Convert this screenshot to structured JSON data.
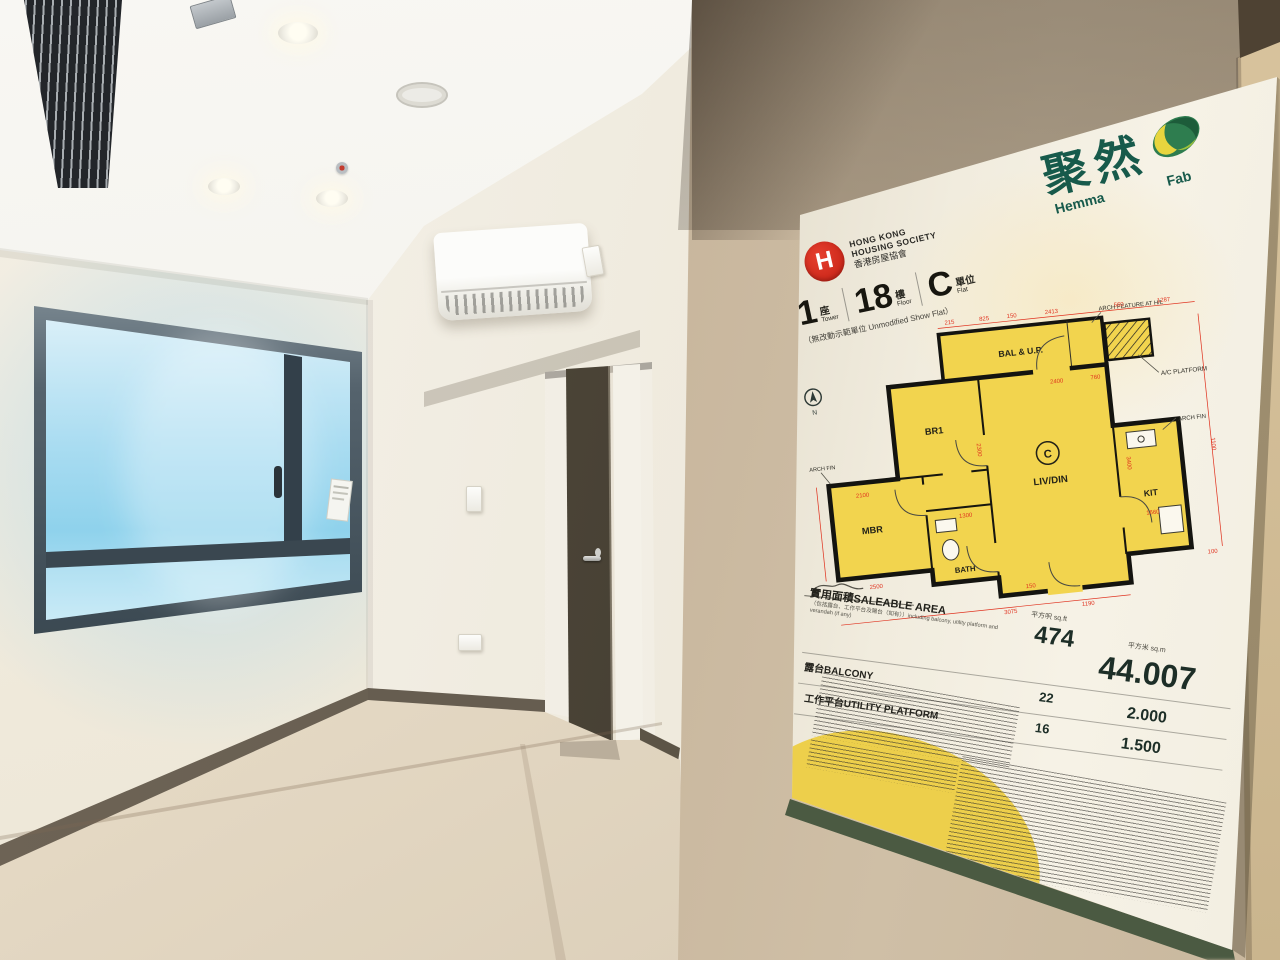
{
  "poster": {
    "brand": {
      "name_zh": "聚然",
      "en_left": "Hemma",
      "en_right": "Fab"
    },
    "org": {
      "logo_letter": "H",
      "line1": "HONG KONG",
      "line2": "HOUSING SOCIETY",
      "line3": "香港房屋協會"
    },
    "unit": {
      "tower_num": "1",
      "tower_zh": "座",
      "tower_en": "Tower",
      "floor_num": "18",
      "floor_zh": "樓",
      "floor_en": "Floor",
      "flat_num": "C",
      "flat_zh": "單位",
      "flat_en": "Flat",
      "note": "（無改動示範單位 Unmodified Show Flat）"
    },
    "plan": {
      "rooms": [
        "BAL & U.P.",
        "BR1",
        "MBR",
        "LIV/DIN",
        "BATH",
        "KIT"
      ],
      "flat_mark": "C",
      "north": "N",
      "labels": {
        "ac_platform": "A/C PLATFORM",
        "arch_feature": "ARCH FEATURE AT H/L",
        "arch_fin": "ARCH FIN"
      },
      "dims": [
        "215",
        "825",
        "150",
        "2413",
        "560",
        "1287",
        "2400",
        "760",
        "1100",
        "3400",
        "2300",
        "1300",
        "1660",
        "2100",
        "2500",
        "3075",
        "1190",
        "150",
        "100"
      ]
    },
    "table": {
      "col_sqft": "平方呎 sq.ft",
      "col_sqm": "平方米 sq.m",
      "rows": [
        {
          "zh": "實用面積",
          "en": "SALEABLE AREA",
          "sub": "（包括露台、工作平台及陽台（如有））including balcony, utility platform and verandah (if any)",
          "sqft": "474",
          "sqm": "44.007"
        },
        {
          "zh": "露台",
          "en": "BALCONY",
          "sqft": "22",
          "sqm": "2.000"
        },
        {
          "zh": "工作平台",
          "en": "UTILITY PLATFORM",
          "sqft": "16",
          "sqm": "1.500"
        }
      ]
    },
    "colors": {
      "accent_red": "#d5281e",
      "brand_green": "#175a4b",
      "plan_yellow": "#f2d44e",
      "dim_red": "#e0321f"
    }
  }
}
